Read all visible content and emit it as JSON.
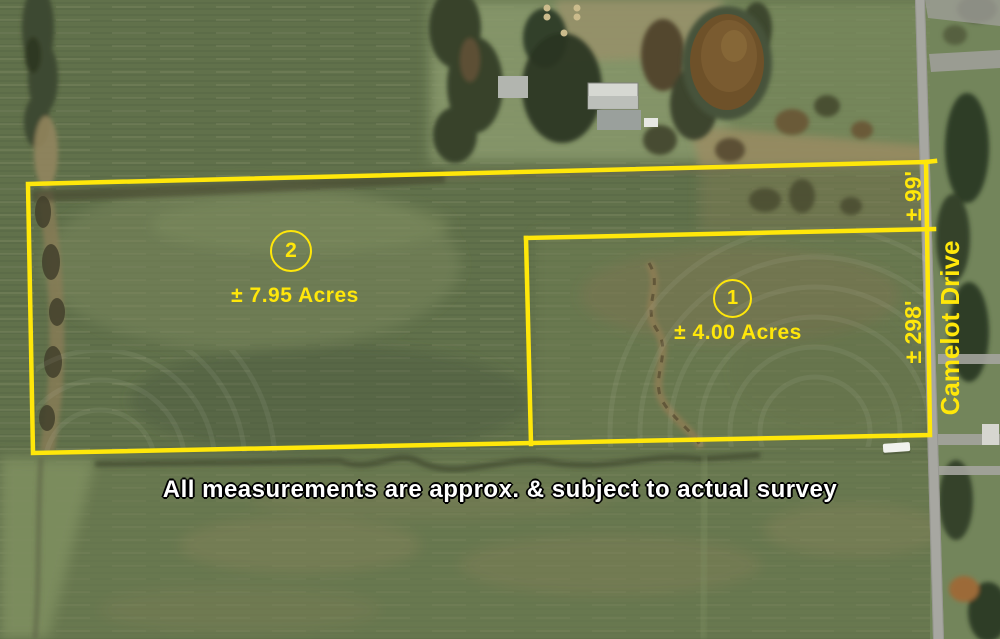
{
  "parcels": [
    {
      "number": "1",
      "acreage": "± 4.00 Acres"
    },
    {
      "number": "2",
      "acreage": "± 7.95 Acres"
    }
  ],
  "measurements": {
    "parcel2_road_frontage": "± 99'",
    "parcel1_road_frontage": "± 298'"
  },
  "road": {
    "name": "Camelot Drive"
  },
  "disclaimer": "All measurements are approx. & subject to actual survey",
  "annotation_colors": {
    "boundary_yellow": "#FFE70A",
    "disclaimer_fill": "#FFFFFF",
    "disclaimer_outline": "#000000"
  }
}
